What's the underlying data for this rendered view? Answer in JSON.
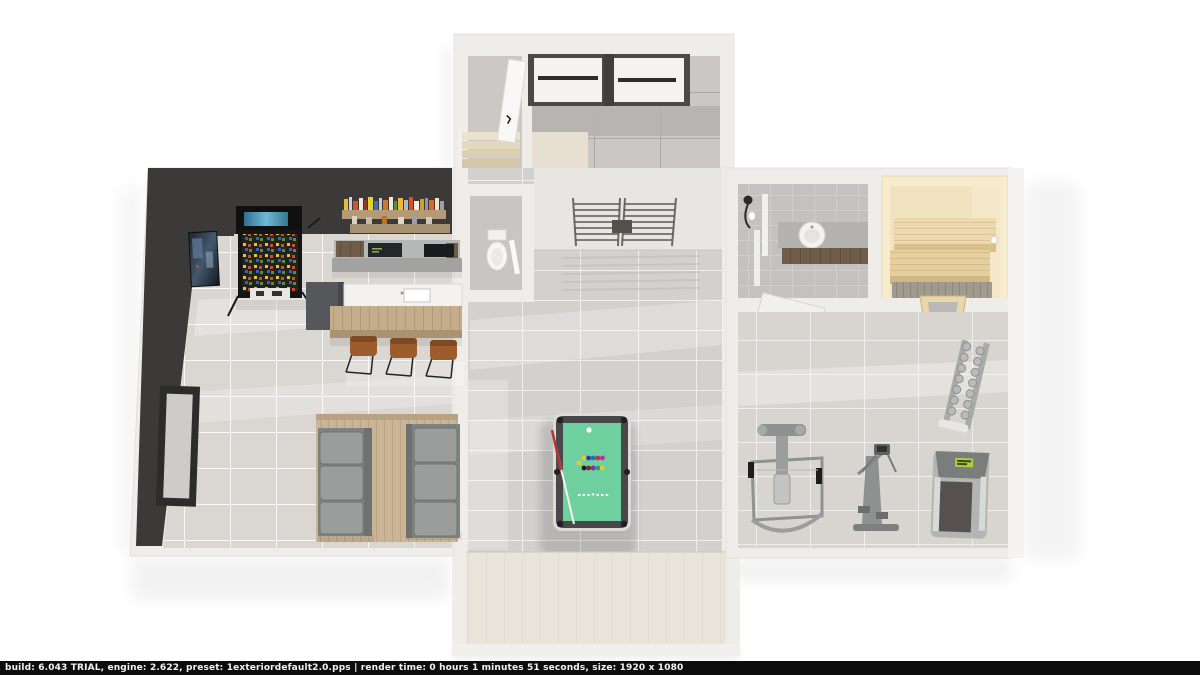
{
  "app": {
    "type": "3d-floorplan-render-viewer"
  },
  "status_bar": {
    "build": "6.043 TRIAL",
    "engine": "2.622",
    "preset": "1exteriordefault2.0.pps",
    "render_time": "0 hours 1 minutes 51 seconds",
    "size": "1920 x 1080",
    "text": "build: 6.043 TRIAL,  engine: 2.622,  preset: 1exteriordefault2.0.pps |  render time: 0 hours 1 minutes 51 seconds,  size: 1920 x 1080"
  },
  "scene": {
    "view": "top-down-perspective-3d-floor-plan",
    "rooms": [
      {
        "name": "entry-hall",
        "features": [
          "double-entry-door",
          "interior-door",
          "staircase"
        ]
      },
      {
        "name": "game-room",
        "features": [
          "wall-poster",
          "pinball-machine",
          "bottle-shelf",
          "back-counter",
          "bar-island",
          "bar-stools",
          "basement-window",
          "sofa-platform",
          "sofa-left",
          "sofa-right"
        ]
      },
      {
        "name": "hallway",
        "features": [
          "toilet",
          "wall-bars",
          "pool-table",
          "cue-stick"
        ]
      },
      {
        "name": "bathroom",
        "features": [
          "shower",
          "glass-partition",
          "vanity-sink"
        ]
      },
      {
        "name": "sauna",
        "features": [
          "bench-upper",
          "bench-lower",
          "glass-door"
        ]
      },
      {
        "name": "gym",
        "features": [
          "multi-gym-machine",
          "elliptical-trainer",
          "treadmill",
          "dumbbell-rack"
        ]
      },
      {
        "name": "unfinished-room",
        "features": []
      }
    ]
  },
  "palette": {
    "page_bg": "#ffffff",
    "statusbar_bg": "#0d0d0d",
    "statusbar_text": "#f3f3f3",
    "wall_white": "#efedea",
    "wall_dark": "#3b3a38",
    "floor_tile": "#dad7d3",
    "hall_tile": "#d3d1ce",
    "bath_tile": "#c4c2c0",
    "sauna_cream": "#f7ecce",
    "sauna_wood": "#ecd9ad",
    "felt_green": "#6fd09f",
    "rail_dark": "#48484a",
    "stool_rust": "#9c5c2c",
    "sofa_gray": "#9a9d9b",
    "beige_floor": "#e9e4da"
  }
}
